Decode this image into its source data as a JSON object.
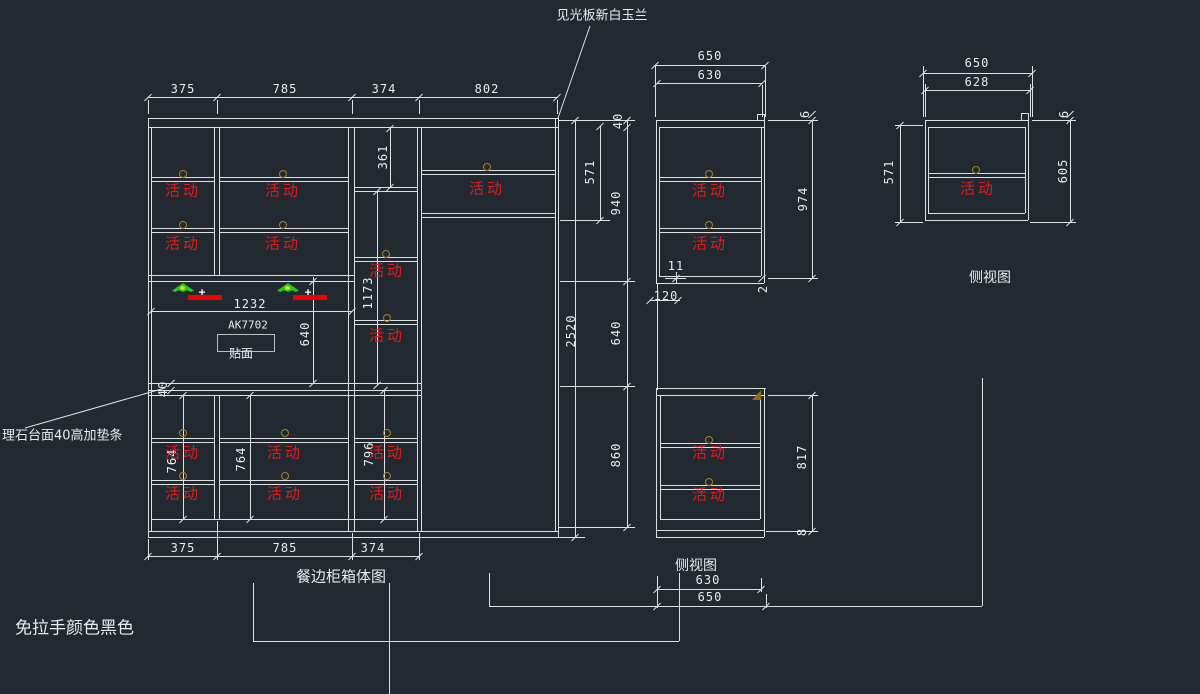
{
  "colors": {
    "background": "#232931",
    "line": "#dde1e4",
    "movable_red": "#e11b1b",
    "pin_gold": "#a08520",
    "light_green": "#1ecb1e",
    "bar_red": "#f20000",
    "triangle_gold": "#8f6c10"
  },
  "labels": {
    "movable": "活动",
    "plus": "+",
    "top_note": "见光板新白玉兰",
    "left_note": "理石台面40高加垫条",
    "bottom_note": "免拉手颜色黑色",
    "main_title": "餐边柜箱体图",
    "side_view_mid": "侧视图",
    "side_view_right": "侧视图",
    "panel_code": "AK7702",
    "veneer": "贴面"
  },
  "drawing": {
    "texts": [
      {
        "t": "见光板新白玉兰",
        "x": 602,
        "y": 14,
        "fs": 13,
        "a": "ctr"
      },
      {
        "t": "理石台面40高加垫条",
        "x": 2,
        "y": 434,
        "fs": 13,
        "a": "lft"
      },
      {
        "t": "免拉手颜色黑色",
        "x": 15,
        "y": 626,
        "fs": 17,
        "a": "lft"
      },
      {
        "t": "餐边柜箱体图",
        "x": 341,
        "y": 576,
        "fs": 15,
        "a": "ctr"
      },
      {
        "t": "侧视图",
        "x": 696,
        "y": 565,
        "fs": 14,
        "a": "ctr"
      },
      {
        "t": "侧视图",
        "x": 990,
        "y": 277,
        "fs": 14,
        "a": "ctr"
      },
      {
        "t": "AK7702",
        "x": 248,
        "y": 325,
        "fs": 11,
        "a": "ctr",
        "mono": 1
      },
      {
        "t": "贴面",
        "x": 241,
        "y": 353,
        "fs": 12,
        "a": "ctr"
      }
    ],
    "dims": [
      {
        "t": "375",
        "x": 183,
        "y": 89
      },
      {
        "t": "785",
        "x": 285,
        "y": 89
      },
      {
        "t": "374",
        "x": 384,
        "y": 89
      },
      {
        "t": "802",
        "x": 487,
        "y": 89
      },
      {
        "t": "375",
        "x": 183,
        "y": 548
      },
      {
        "t": "785",
        "x": 285,
        "y": 548
      },
      {
        "t": "374",
        "x": 373,
        "y": 548
      },
      {
        "t": "1232",
        "x": 250,
        "y": 304
      },
      {
        "t": "640",
        "x": 305,
        "y": 334,
        "rot": 1
      },
      {
        "t": "40",
        "x": 163,
        "y": 389,
        "rot": 1
      },
      {
        "t": "361",
        "x": 383,
        "y": 157,
        "rot": 1
      },
      {
        "t": "1173",
        "x": 368,
        "y": 293,
        "rot": 1
      },
      {
        "t": "764",
        "x": 172,
        "y": 461,
        "rot": 1
      },
      {
        "t": "764",
        "x": 241,
        "y": 459,
        "rot": 1
      },
      {
        "t": "796",
        "x": 369,
        "y": 454,
        "rot": 1
      },
      {
        "t": "2520",
        "x": 571,
        "y": 331,
        "rot": 1
      },
      {
        "t": "571",
        "x": 590,
        "y": 172,
        "rot": 1
      },
      {
        "t": "40",
        "x": 618,
        "y": 121,
        "rot": 1
      },
      {
        "t": "940",
        "x": 616,
        "y": 203,
        "rot": 1
      },
      {
        "t": "640",
        "x": 616,
        "y": 333,
        "rot": 1
      },
      {
        "t": "860",
        "x": 616,
        "y": 455,
        "rot": 1
      },
      {
        "t": "650",
        "x": 710,
        "y": 56
      },
      {
        "t": "630",
        "x": 710,
        "y": 75
      },
      {
        "t": "974",
        "x": 803,
        "y": 199,
        "rot": 1
      },
      {
        "t": "6",
        "x": 805,
        "y": 114,
        "rot": 1
      },
      {
        "t": "2",
        "x": 763,
        "y": 289,
        "rot": 1
      },
      {
        "t": "11",
        "x": 676,
        "y": 266
      },
      {
        "t": "120",
        "x": 666,
        "y": 296
      },
      {
        "t": "817",
        "x": 802,
        "y": 457,
        "rot": 1
      },
      {
        "t": "8",
        "x": 802,
        "y": 532,
        "rot": 1
      },
      {
        "t": "630",
        "x": 708,
        "y": 580
      },
      {
        "t": "650",
        "x": 710,
        "y": 597
      },
      {
        "t": "650",
        "x": 977,
        "y": 63
      },
      {
        "t": "628",
        "x": 977,
        "y": 82
      },
      {
        "t": "571",
        "x": 889,
        "y": 172,
        "rot": 1
      },
      {
        "t": "605",
        "x": 1063,
        "y": 171,
        "rot": 1
      },
      {
        "t": "6",
        "x": 1064,
        "y": 114,
        "rot": 1
      }
    ],
    "movable_positions": [
      [
        183,
        190
      ],
      [
        283,
        190
      ],
      [
        183,
        243
      ],
      [
        283,
        243
      ],
      [
        487,
        188
      ],
      [
        387,
        270
      ],
      [
        387,
        335
      ],
      [
        183,
        452
      ],
      [
        285,
        452
      ],
      [
        387,
        452
      ],
      [
        183,
        493
      ],
      [
        285,
        493
      ],
      [
        387,
        493
      ],
      [
        710,
        190
      ],
      [
        710,
        243
      ],
      [
        710,
        452
      ],
      [
        710,
        494
      ],
      [
        978,
        188
      ]
    ],
    "circles": [
      [
        183,
        174
      ],
      [
        283,
        174
      ],
      [
        183,
        225
      ],
      [
        283,
        225
      ],
      [
        487,
        167
      ],
      [
        386,
        254
      ],
      [
        387,
        318
      ],
      [
        183,
        433
      ],
      [
        285,
        433
      ],
      [
        387,
        433
      ],
      [
        183,
        476
      ],
      [
        285,
        476
      ],
      [
        387,
        476
      ],
      [
        709,
        174
      ],
      [
        709,
        225
      ],
      [
        709,
        440
      ],
      [
        709,
        482
      ],
      [
        976,
        170
      ]
    ],
    "hlines": [
      [
        148,
        118,
        558
      ],
      [
        148,
        127,
        558
      ],
      [
        151,
        177,
        214
      ],
      [
        151,
        181,
        214
      ],
      [
        219,
        177,
        348
      ],
      [
        219,
        181,
        348
      ],
      [
        151,
        228,
        214
      ],
      [
        151,
        232,
        214
      ],
      [
        219,
        228,
        348
      ],
      [
        219,
        232,
        348
      ],
      [
        148,
        275,
        354
      ],
      [
        148,
        281,
        354
      ],
      [
        354,
        187,
        417
      ],
      [
        354,
        191,
        417
      ],
      [
        354,
        257,
        417
      ],
      [
        354,
        261,
        417
      ],
      [
        354,
        320,
        417
      ],
      [
        354,
        324,
        417
      ],
      [
        421,
        170,
        555
      ],
      [
        421,
        174,
        555
      ],
      [
        421,
        213,
        555
      ],
      [
        421,
        217,
        555
      ],
      [
        148,
        383,
        421
      ],
      [
        148,
        390,
        421
      ],
      [
        148,
        395,
        421
      ],
      [
        151,
        438,
        214
      ],
      [
        151,
        442,
        214
      ],
      [
        219,
        438,
        348
      ],
      [
        219,
        442,
        348
      ],
      [
        354,
        438,
        417
      ],
      [
        354,
        442,
        417
      ],
      [
        151,
        480,
        214
      ],
      [
        151,
        484,
        214
      ],
      [
        219,
        480,
        348
      ],
      [
        219,
        484,
        348
      ],
      [
        354,
        480,
        417
      ],
      [
        354,
        484,
        417
      ],
      [
        151,
        519,
        417
      ],
      [
        148,
        531,
        558
      ],
      [
        148,
        537,
        558
      ],
      [
        148,
        97,
        558
      ],
      [
        148,
        556,
        419
      ],
      [
        151,
        311,
        352
      ],
      [
        558,
        120,
        635
      ],
      [
        558,
        537,
        585
      ],
      [
        560,
        281,
        635
      ],
      [
        560,
        386,
        635
      ],
      [
        558,
        527,
        635
      ],
      [
        560,
        220,
        610
      ],
      [
        655,
        65,
        765
      ],
      [
        657,
        83,
        762
      ],
      [
        757,
        114,
        764
      ],
      [
        656,
        120,
        764
      ],
      [
        659,
        127,
        764
      ],
      [
        659,
        177,
        761
      ],
      [
        659,
        181,
        761
      ],
      [
        659,
        228,
        761
      ],
      [
        659,
        232,
        761
      ],
      [
        659,
        276,
        761
      ],
      [
        656,
        283,
        764
      ],
      [
        656,
        388,
        766
      ],
      [
        656,
        395,
        764
      ],
      [
        660,
        443,
        760
      ],
      [
        660,
        447,
        760
      ],
      [
        660,
        485,
        760
      ],
      [
        660,
        489,
        760
      ],
      [
        660,
        519,
        760
      ],
      [
        656,
        530,
        764
      ],
      [
        656,
        537,
        764
      ],
      [
        768,
        120,
        818
      ],
      [
        768,
        278,
        818
      ],
      [
        768,
        395,
        818
      ],
      [
        766,
        531,
        818
      ],
      [
        650,
        300,
        680
      ],
      [
        665,
        278,
        686
      ],
      [
        657,
        589,
        761
      ],
      [
        489,
        606,
        982
      ],
      [
        253,
        641,
        679
      ],
      [
        923,
        73,
        1032
      ],
      [
        925,
        90,
        1030
      ],
      [
        1021,
        113,
        1028
      ],
      [
        925,
        120,
        1028
      ],
      [
        928,
        127,
        1025
      ],
      [
        928,
        173,
        1025
      ],
      [
        928,
        177,
        1025
      ],
      [
        928,
        213,
        1025
      ],
      [
        925,
        220,
        1028
      ],
      [
        1032,
        120,
        1076
      ],
      [
        1030,
        222,
        1076
      ],
      [
        895,
        125,
        923
      ],
      [
        895,
        222,
        923
      ]
    ],
    "vlines": [
      [
        148,
        118,
        537
      ],
      [
        151,
        127,
        531
      ],
      [
        214,
        127,
        275
      ],
      [
        219,
        127,
        275
      ],
      [
        214,
        395,
        519
      ],
      [
        219,
        395,
        519
      ],
      [
        348,
        127,
        531
      ],
      [
        354,
        127,
        531
      ],
      [
        417,
        127,
        531
      ],
      [
        421,
        127,
        531
      ],
      [
        555,
        118,
        531
      ],
      [
        558,
        118,
        537
      ],
      [
        390,
        128,
        187
      ],
      [
        377,
        191,
        385
      ],
      [
        313,
        277,
        383
      ],
      [
        183,
        395,
        519
      ],
      [
        250,
        395,
        519
      ],
      [
        384,
        390,
        519
      ],
      [
        575,
        120,
        537
      ],
      [
        600,
        126,
        220
      ],
      [
        627,
        120,
        527
      ],
      [
        148,
        100,
        114
      ],
      [
        217,
        100,
        114
      ],
      [
        352,
        100,
        114
      ],
      [
        419,
        100,
        114
      ],
      [
        557,
        100,
        114
      ],
      [
        148,
        539,
        560
      ],
      [
        217,
        521,
        560
      ],
      [
        352,
        533,
        560
      ],
      [
        419,
        533,
        560
      ],
      [
        757,
        114,
        120
      ],
      [
        764,
        114,
        283
      ],
      [
        656,
        120,
        283
      ],
      [
        659,
        127,
        276
      ],
      [
        761,
        127,
        276
      ],
      [
        657,
        283,
        390
      ],
      [
        656,
        388,
        537
      ],
      [
        660,
        395,
        519
      ],
      [
        760,
        395,
        519
      ],
      [
        764,
        388,
        537
      ],
      [
        812,
        120,
        278
      ],
      [
        812,
        395,
        531
      ],
      [
        655,
        66,
        117
      ],
      [
        765,
        66,
        117
      ],
      [
        762,
        85,
        117
      ],
      [
        676,
        272,
        284
      ],
      [
        657,
        576,
        608
      ],
      [
        761,
        578,
        592
      ],
      [
        766,
        594,
        608
      ],
      [
        489,
        573,
        606
      ],
      [
        982,
        378,
        606
      ],
      [
        679,
        573,
        641
      ],
      [
        253,
        583,
        641
      ],
      [
        389,
        583,
        694
      ],
      [
        1021,
        113,
        120
      ],
      [
        1028,
        113,
        220
      ],
      [
        925,
        120,
        220
      ],
      [
        928,
        127,
        213
      ],
      [
        1025,
        127,
        213
      ],
      [
        900,
        125,
        222
      ],
      [
        1070,
        120,
        222
      ],
      [
        923,
        66,
        117
      ],
      [
        1032,
        66,
        117
      ],
      [
        925,
        84,
        117
      ],
      [
        1030,
        84,
        117
      ]
    ],
    "ticks": [
      [
        148,
        97
      ],
      [
        217,
        97
      ],
      [
        352,
        97
      ],
      [
        419,
        97
      ],
      [
        557,
        97
      ],
      [
        148,
        556
      ],
      [
        217,
        556
      ],
      [
        352,
        556
      ],
      [
        419,
        556
      ],
      [
        151,
        311
      ],
      [
        352,
        311
      ],
      [
        313,
        281
      ],
      [
        313,
        383
      ],
      [
        390,
        128
      ],
      [
        390,
        187
      ],
      [
        377,
        191
      ],
      [
        377,
        385
      ],
      [
        183,
        395
      ],
      [
        183,
        519
      ],
      [
        250,
        395
      ],
      [
        250,
        519
      ],
      [
        384,
        390
      ],
      [
        384,
        519
      ],
      [
        171,
        383
      ],
      [
        171,
        390
      ],
      [
        575,
        120
      ],
      [
        575,
        537
      ],
      [
        600,
        126
      ],
      [
        600,
        220
      ],
      [
        627,
        120
      ],
      [
        627,
        127
      ],
      [
        627,
        281
      ],
      [
        627,
        386
      ],
      [
        627,
        527
      ],
      [
        655,
        65
      ],
      [
        765,
        65
      ],
      [
        657,
        83
      ],
      [
        762,
        83
      ],
      [
        812,
        114
      ],
      [
        812,
        120
      ],
      [
        812,
        278
      ],
      [
        812,
        395
      ],
      [
        812,
        531
      ],
      [
        762,
        278
      ],
      [
        650,
        300
      ],
      [
        678,
        300
      ],
      [
        676,
        278
      ],
      [
        657,
        589
      ],
      [
        761,
        589
      ],
      [
        657,
        606
      ],
      [
        766,
        606
      ],
      [
        923,
        73
      ],
      [
        1032,
        73
      ],
      [
        925,
        90
      ],
      [
        1030,
        90
      ],
      [
        900,
        125
      ],
      [
        900,
        222
      ],
      [
        1070,
        114
      ],
      [
        1070,
        120
      ],
      [
        1070,
        222
      ]
    ],
    "leaders": [
      [
        590,
        26,
        558,
        118
      ],
      [
        25,
        428,
        165,
        388
      ]
    ],
    "rects": [
      [
        217,
        334,
        56,
        16
      ]
    ],
    "awnings": [
      [
        172,
        283
      ],
      [
        277,
        283
      ]
    ],
    "plus_marks": [
      [
        202,
        292
      ],
      [
        308,
        292
      ]
    ],
    "red_bars": [
      [
        188,
        295
      ],
      [
        293,
        295
      ]
    ],
    "gold_triangles": [
      [
        752,
        390
      ]
    ]
  }
}
